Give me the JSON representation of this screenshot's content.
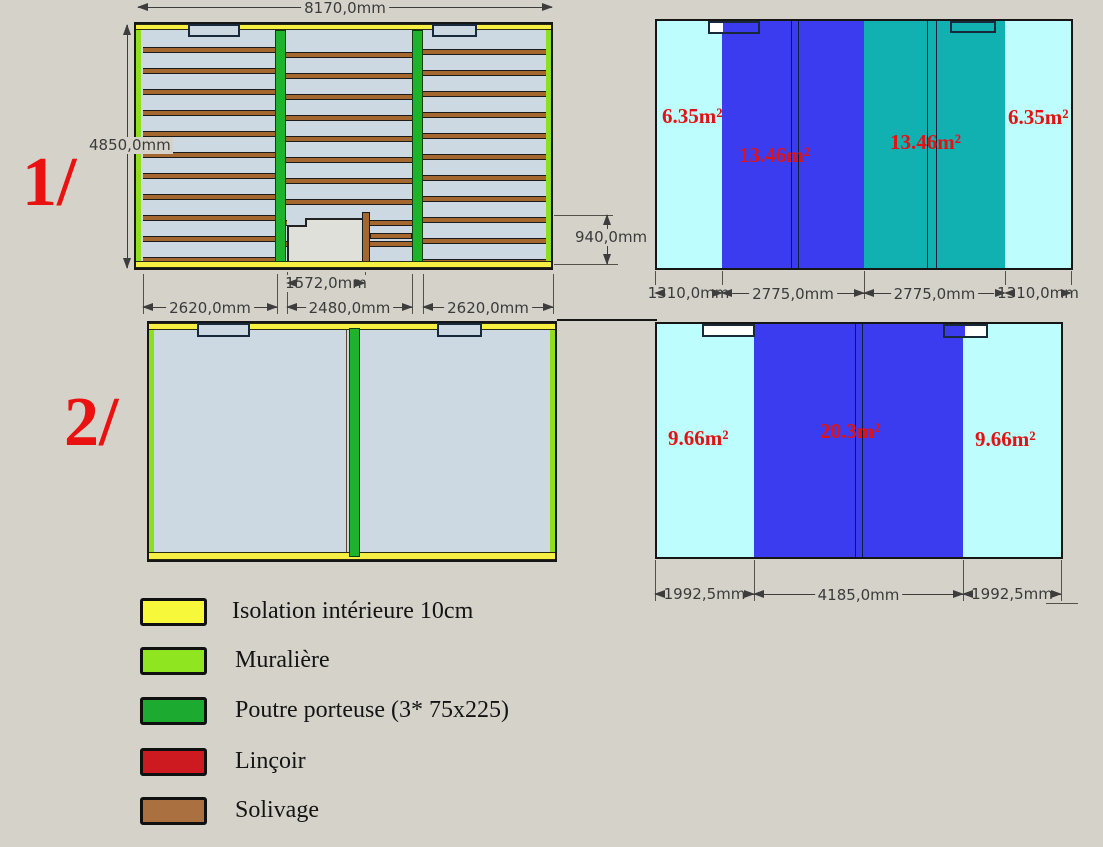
{
  "colors": {
    "background": "#d5d2ca",
    "floor_deck": "#ccd9e2",
    "joist_brown": "#a3672f",
    "beam_green": "#1db42c",
    "muraliere_green": "#8ee520",
    "isolation_yellow": "#f8f83a",
    "lincoir_red": "#cc1a20",
    "solivage_brown": "#aa7040",
    "zone_pale_cyan": "#bdfdfd",
    "zone_blue": "#3b3bef",
    "zone_teal": "#12b1b1",
    "red_text": "#e31212",
    "dim_text": "#3b3b3b"
  },
  "plans": {
    "plan1": {
      "index_label": "1/",
      "dims": {
        "width": "8170,0mm",
        "height": "4850,0mm",
        "opening_width": "1572,0mm",
        "opening_height": "940,0mm",
        "bay_left": "2620,0mm",
        "bay_center": "2480,0mm",
        "bay_right": "2620,0mm"
      }
    },
    "plan2": {
      "index_label": "2/"
    }
  },
  "area_diagram_top": {
    "zones": [
      {
        "area": "6.35m²",
        "width": "1310,0mm",
        "color": "#bdfdfd"
      },
      {
        "area": "13.46m²",
        "width": "2775,0mm",
        "color": "#3b3bef"
      },
      {
        "area": "13.46m²",
        "width": "2775,0mm",
        "color": "#12b1b1"
      },
      {
        "area": "6.35m²",
        "width": "1310,0mm",
        "color": "#bdfdfd"
      }
    ]
  },
  "area_diagram_bottom": {
    "zones": [
      {
        "area": "9.66m²",
        "width": "1992,5mm",
        "color": "#bdfdfd"
      },
      {
        "area": "20.3m²",
        "width": "4185,0mm",
        "color": "#3b3bef"
      },
      {
        "area": "9.66m²",
        "width": "1992,5mm",
        "color": "#bdfdfd"
      }
    ]
  },
  "legend": {
    "items": [
      {
        "label": "Isolation intérieure 10cm",
        "color": "#f8f83a"
      },
      {
        "label": "Muralière",
        "color": "#8ee520"
      },
      {
        "label": "Poutre porteuse (3* 75x225)",
        "color": "#1caa30"
      },
      {
        "label": "Linçoir",
        "color": "#cc1a20"
      },
      {
        "label": "Solivage",
        "color": "#aa7040"
      }
    ]
  }
}
